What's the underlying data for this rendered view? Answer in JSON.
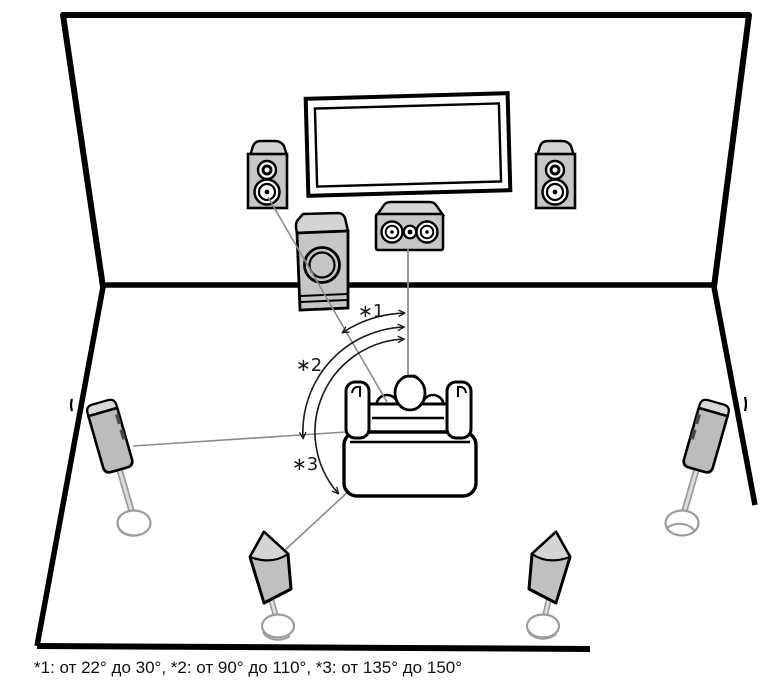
{
  "diagram": {
    "type": "7.1-surround-speaker-placement",
    "caption": "*1: от 22° до 30°, *2: от 90° до 110°, *3: от 135° до 150°",
    "labels": {
      "angle1": "∗1",
      "angle2": "∗2",
      "angle3": "∗3"
    },
    "angles": {
      "front": {
        "ref": "*1",
        "from_deg": 22,
        "to_deg": 30
      },
      "surround": {
        "ref": "*2",
        "from_deg": 90,
        "to_deg": 110
      },
      "rear": {
        "ref": "*3",
        "from_deg": 135,
        "to_deg": 150
      }
    },
    "components": [
      "tv",
      "front-left-speaker",
      "front-right-speaker",
      "center-speaker",
      "subwoofer",
      "surround-left-speaker",
      "surround-right-speaker",
      "rear-left-speaker",
      "rear-right-speaker",
      "sofa",
      "listener"
    ],
    "colors": {
      "outline": "#000000",
      "speaker_fill": "#c6c6c6",
      "speaker_top_fill": "#d8d8d8",
      "stand": "#9c9c9c",
      "guide_line": "#8c8c8c",
      "arc_line": "#1c1c1c",
      "background": "#ffffff"
    }
  }
}
